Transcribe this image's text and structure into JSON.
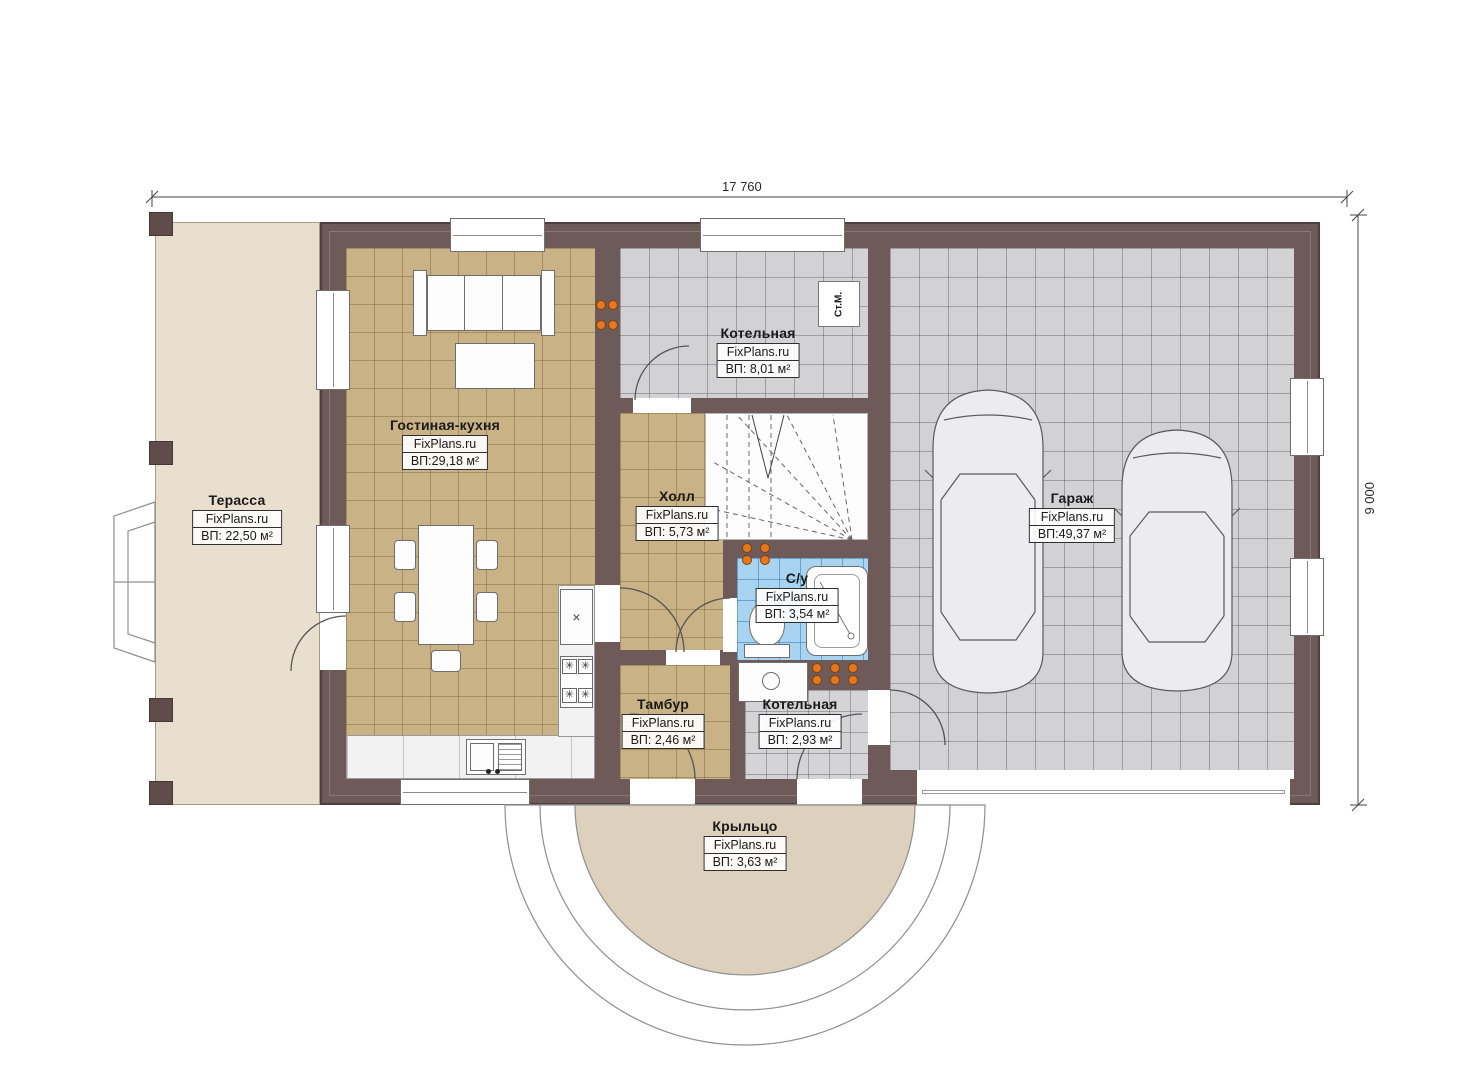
{
  "plan": {
    "type": "floor-plan",
    "dimensions": {
      "width_label": "17 760",
      "height_label": "9 000"
    },
    "rooms": [
      {
        "id": "terrace",
        "name": "Терасса",
        "brand": "FixPlans.ru",
        "area": "ВП: 22,50 м²"
      },
      {
        "id": "living-kitchen",
        "name": "Гостиная-кухня",
        "brand": "FixPlans.ru",
        "area": "ВП:29,18 м²"
      },
      {
        "id": "boiler-top",
        "name": "Котельная",
        "brand": "FixPlans.ru",
        "area": "ВП: 8,01 м²"
      },
      {
        "id": "hall",
        "name": "Холл",
        "brand": "FixPlans.ru",
        "area": "ВП: 5,73 м²"
      },
      {
        "id": "garage",
        "name": "Гараж",
        "brand": "FixPlans.ru",
        "area": "ВП:49,37 м²"
      },
      {
        "id": "bathroom",
        "name": "С/у",
        "brand": "FixPlans.ru",
        "area": "ВП: 3,54 м²"
      },
      {
        "id": "tambour",
        "name": "Тамбур",
        "brand": "FixPlans.ru",
        "area": "ВП: 2,46 м²"
      },
      {
        "id": "boiler-bottom",
        "name": "Котельная",
        "brand": "FixPlans.ru",
        "area": "ВП: 2,93 м²"
      },
      {
        "id": "porch",
        "name": "Крыльцо",
        "brand": "FixPlans.ru",
        "area": "ВП: 3,63 м²"
      }
    ],
    "labels": {
      "stm": "Ст.М."
    },
    "colors": {
      "wall": "#6e5a59",
      "tile_tan": "#c9b285",
      "tile_gray": "#d2d2d4",
      "tile_blue": "#a9d4f1",
      "terrace": "#e9dfcf",
      "porch": "#ddd0bc",
      "radiator": "#e6771e"
    }
  }
}
